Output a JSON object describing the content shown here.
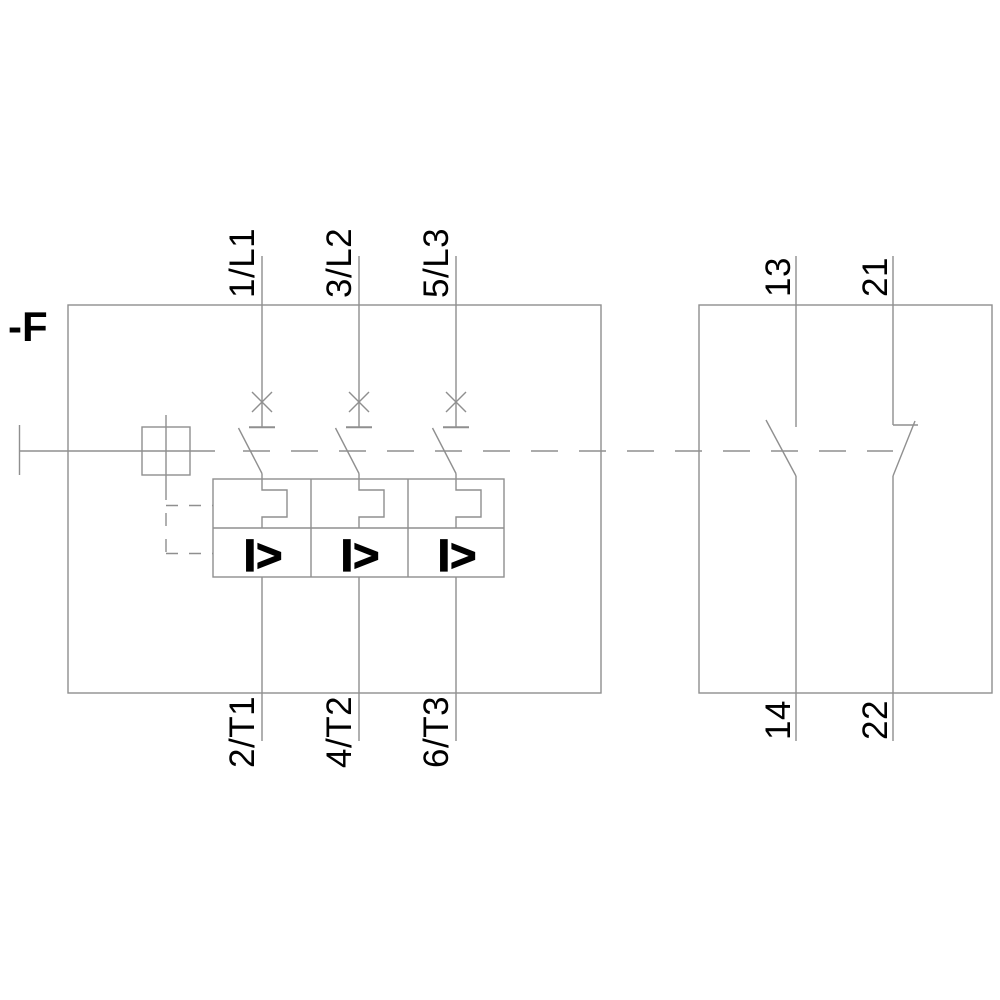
{
  "diagram": {
    "title_semantic": "Motor starter protector / circuit breaker wiring schematic",
    "device_label": "-F",
    "colors": {
      "background": "#ffffff",
      "line": "#8f8f8f",
      "text": "#000000"
    },
    "main_poles": [
      {
        "top_terminal": "1/L1",
        "bottom_terminal": "2/T1"
      },
      {
        "top_terminal": "3/L2",
        "bottom_terminal": "4/T2"
      },
      {
        "top_terminal": "5/L3",
        "bottom_terminal": "6/T3"
      }
    ],
    "magnetic_release_symbol": "I>",
    "aux_contacts": [
      {
        "type": "NO",
        "top_terminal": "13",
        "bottom_terminal": "14"
      },
      {
        "type": "NC",
        "top_terminal": "21",
        "bottom_terminal": "22"
      }
    ]
  }
}
